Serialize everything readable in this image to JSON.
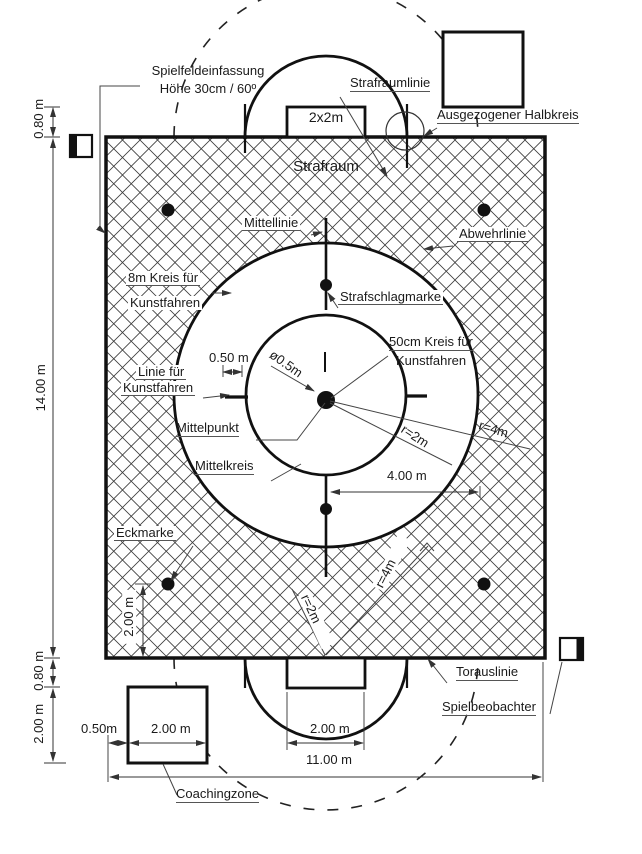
{
  "labels": {
    "enclosure1": "Spielfeldeinfassung",
    "enclosure2": "Höhe 30cm / 60º",
    "strafraumlinie": "Strafraumlinie",
    "goal_size": "2x2m",
    "ausgezogener_halbkreis": "Ausgezogener Halbkreis",
    "strafraum": "Strafraum",
    "mittellinie": "Mittellinie",
    "abwehrlinie": "Abwehrlinie",
    "kreis8_line1": "8m Kreis für",
    "kreis8_line2": "Kunstfahren",
    "strafschlagmarke": "Strafschlagmarke",
    "kreis50_line1": "50cm Kreis für",
    "kreis50_line2": "Kunstfahren",
    "linie_line1": "Linie für",
    "linie_line2": "Kunstfahren",
    "mittelpunkt": "Mittelpunkt",
    "mittelkreis": "Mittelkreis",
    "eckmarke": "Eckmarke",
    "torauslinie": "Torauslinie",
    "spielbeobachter": "Spielbeobachter",
    "coachingzone": "Coachingzone",
    "diameter_05": "ø0.5m",
    "r2m": "r=2m",
    "r4m": "r=4m"
  },
  "dimensions": {
    "d_050_top": "0.50 m",
    "d_400": "4.00 m",
    "d_1400": "14.00 m",
    "d_080": "0.80 m",
    "d_200": "2.00 m",
    "d_050_bottom": "0.50m",
    "d_1100": "11.00 m"
  },
  "colors": {
    "line": "#111111",
    "hatch": "#3c3c3c",
    "dim": "#333333"
  }
}
